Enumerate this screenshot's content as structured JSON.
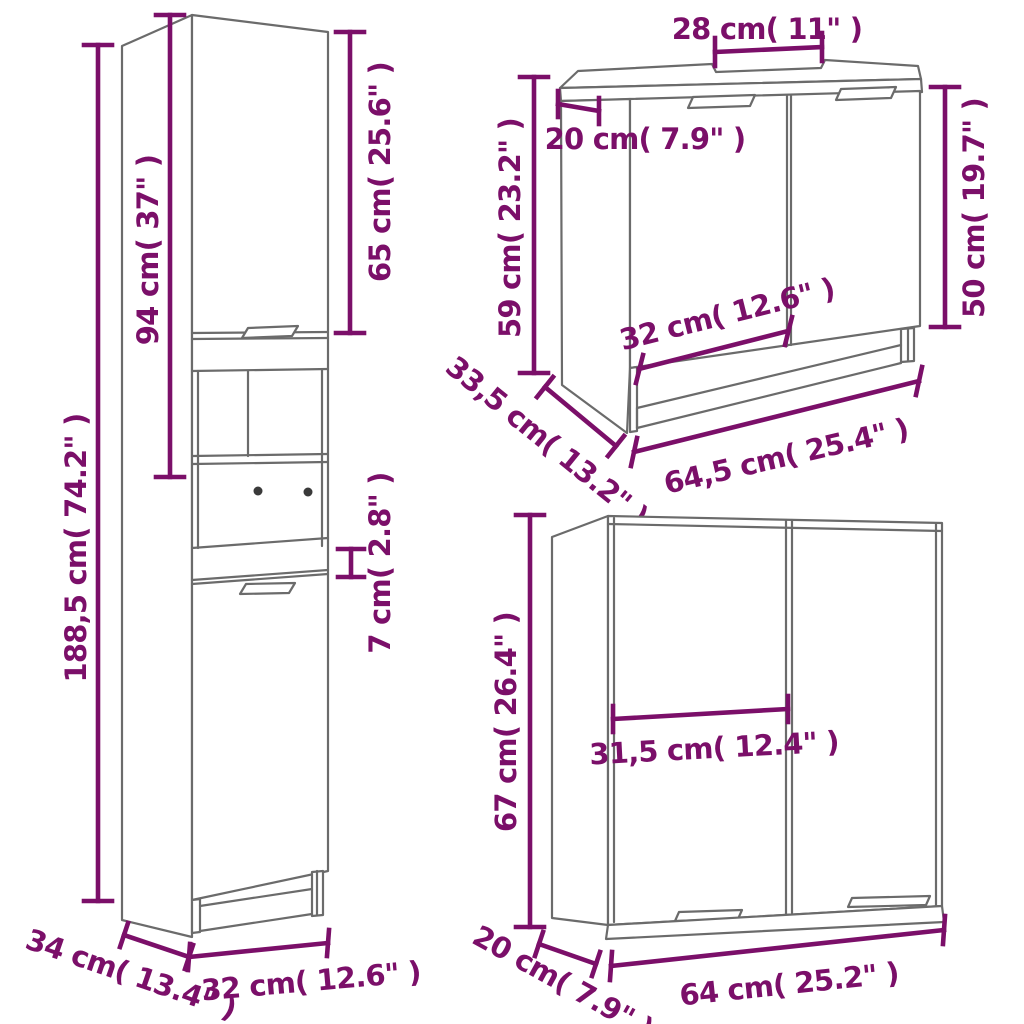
{
  "title": "3 Piece Bathroom Furniture Set — dimensions diagram",
  "colors": {
    "dimension_accent": "#7B0F69",
    "cabinet_outline": "#6B6B6B",
    "screw_dot": "#3A3A3A",
    "background": "#FFFFFF"
  },
  "cabinets": {
    "tall": {
      "label": "tall-bathroom-cabinet",
      "dims": {
        "total_height": "188,5 cm( 74.2\" )",
        "upper_section_height": "94 cm( 37\" )",
        "upper_door_height": "65 cm( 25.6\" )",
        "middle_band_height": "7 cm( 2.8\" )",
        "width": "32 cm( 12.6\" )",
        "depth": "34 cm( 13.4\" )"
      }
    },
    "sink": {
      "label": "sink-cabinet",
      "dims": {
        "cutout_width": "28 cm( 11\" )",
        "cutout_side_offset": "20 cm( 7.9\" )",
        "height": "59 cm( 23.2\" )",
        "door_height": "50 cm( 19.7\" )",
        "door_width": "32 cm( 12.6\" )",
        "depth": "33,5 cm( 13.2\" )",
        "width": "64,5 cm( 25.4\" )"
      }
    },
    "mirror": {
      "label": "mirror-cabinet",
      "dims": {
        "height": "67 cm( 26.4\" )",
        "door_width": "31,5 cm( 12.4\" )",
        "depth": "20 cm( 7.9\" )",
        "width": "64 cm( 25.2\" )"
      }
    }
  }
}
